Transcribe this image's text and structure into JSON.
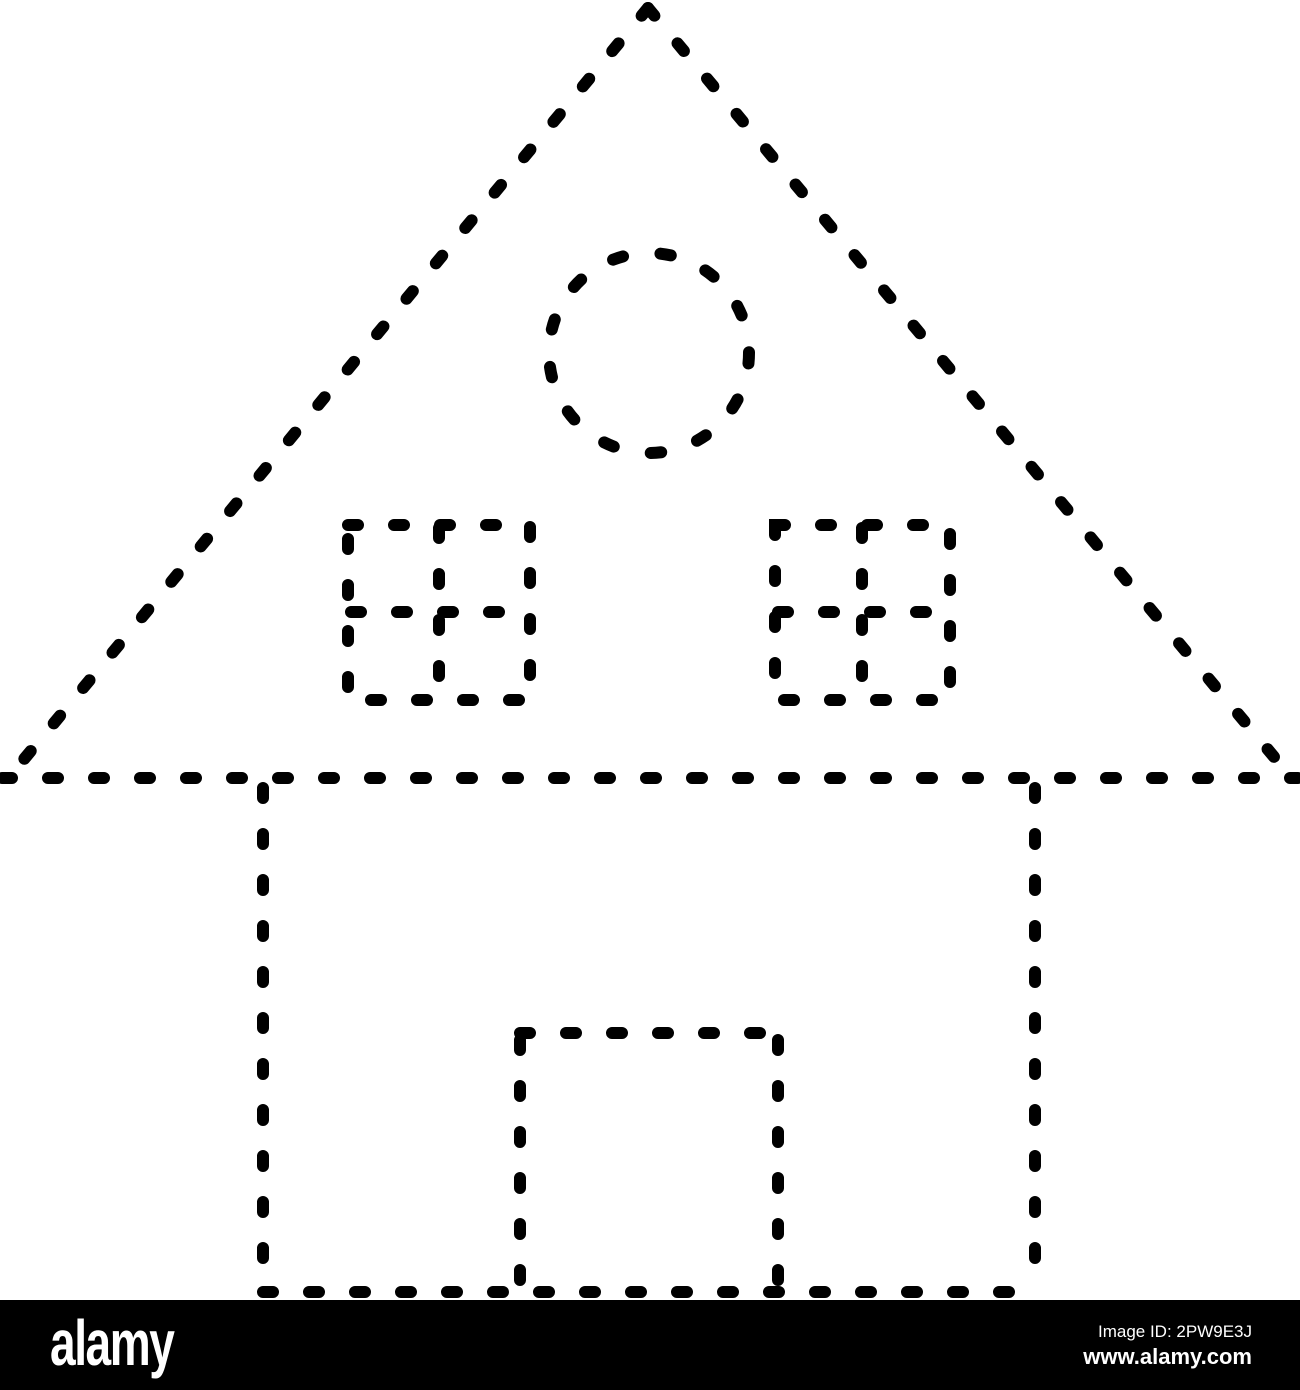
{
  "page": {
    "background": "#ffffff"
  },
  "artwork": {
    "description": "Dashed-line tracing outline of a house: triangular roof containing a circle window and two four-pane square windows, square house body with a door",
    "ink_color": "#000000",
    "shapes": [
      "roof-triangle",
      "roof-base-line",
      "attic-circle-window",
      "attic-window-left",
      "attic-window-right",
      "house-body",
      "door"
    ]
  },
  "watermark_bar": {
    "background": "#000000",
    "text_color": "#ffffff",
    "logo": "alamy",
    "image_id": "Image ID: 2PW9E3J",
    "website": "www.alamy.com"
  }
}
